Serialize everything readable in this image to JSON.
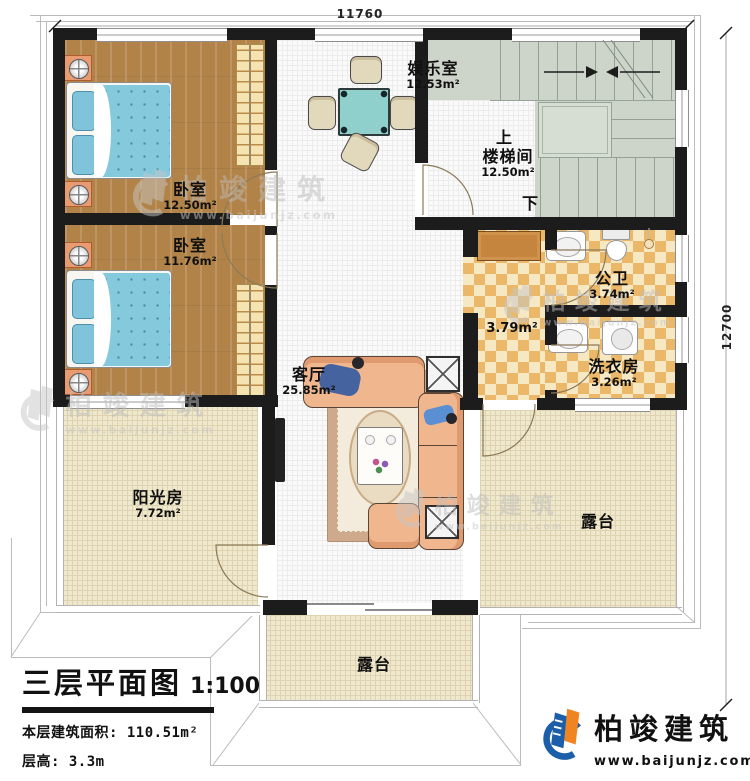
{
  "plan": {
    "dim_top": "11760",
    "dim_right": "12700",
    "rooms": {
      "entertainment": {
        "name": "娱乐室",
        "area": "12.53m²"
      },
      "stairwell": {
        "name": "楼梯间",
        "area": "12.50m²",
        "up_label": "上",
        "down_label": "下"
      },
      "bedroom1": {
        "name": "卧室",
        "area": "12.50m²"
      },
      "bedroom2": {
        "name": "卧室",
        "area": "11.76m²"
      },
      "bathroom": {
        "name": "公卫",
        "area": "3.74m²"
      },
      "hallway": {
        "area": "3.79m²"
      },
      "laundry": {
        "name": "洗衣房",
        "area": "3.26m²"
      },
      "living": {
        "name": "客厅",
        "area": "25.85m²"
      },
      "sunroom": {
        "name": "阳光房",
        "area": "7.72m²"
      },
      "terrace_right": {
        "name": "露台"
      },
      "terrace_bottom": {
        "name": "露台"
      }
    },
    "title_block": {
      "title": "三层平面图",
      "scale": "1:100",
      "area_line": "本层建筑面积: 110.51m²",
      "height_line": "层高: 3.3m"
    },
    "brand": {
      "name": "柏竣建筑",
      "website": "www.baijunjz.com"
    },
    "watermark": {
      "name": "柏竣建筑",
      "website": "www.baijunjz.com"
    },
    "colors": {
      "wall": "#1c1c1c",
      "wood_floor": "#b28348",
      "tile_light": "#f7e8c4",
      "tile_dark": "#eab868",
      "stair_floor": "#cdd4c9",
      "terrace_floor": "#efe8cc",
      "bed_blue": "#85c9dd",
      "brand_blue": "#1b5ea9",
      "brand_orange": "#f08421"
    }
  }
}
